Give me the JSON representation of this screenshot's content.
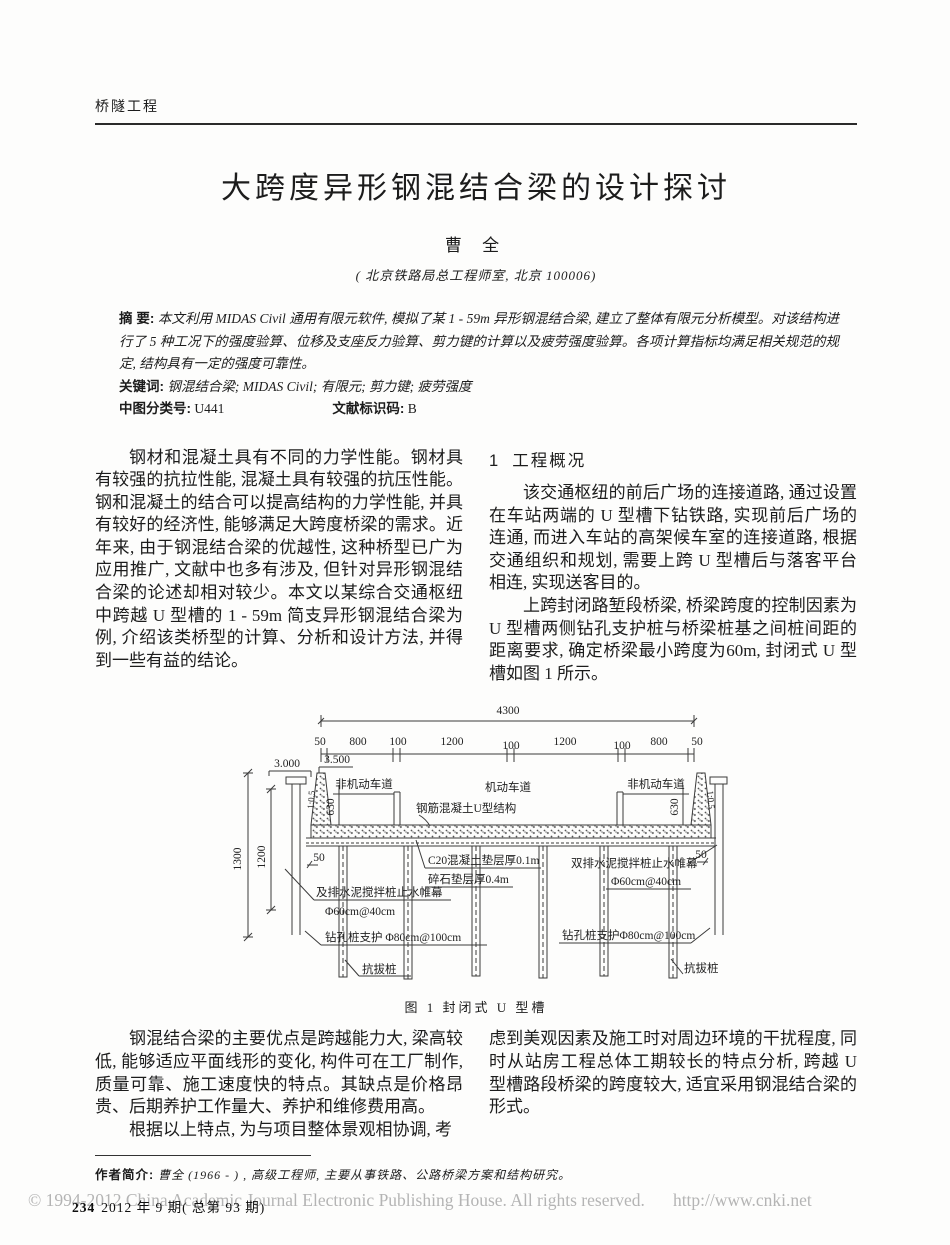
{
  "page": {
    "column_header": "桥隧工程",
    "title": "大跨度异形钢混结合梁的设计探讨",
    "author": "曹  全",
    "affiliation": "( 北京铁路局总工程师室, 北京  100006)"
  },
  "abstract": {
    "label": "摘  要:",
    "text": "本文利用 MIDAS Civil 通用有限元软件, 模拟了某 1 - 59m 异形钢混结合梁, 建立了整体有限元分析模型。对该结构进行了 5 种工况下的强度验算、位移及支座反力验算、剪力键的计算以及疲劳强度验算。各项计算指标均满足相关规范的规定, 结构具有一定的强度可靠性。",
    "keywords_label": "关键词:",
    "keywords": "钢混结合梁;  MIDAS Civil;  有限元;  剪力键;  疲劳强度",
    "clc_label": "中图分类号:",
    "clc_value": "U441",
    "doc_label": "文献标识码:",
    "doc_value": "B"
  },
  "body": {
    "intro": "钢材和混凝土具有不同的力学性能。钢材具有较强的抗拉性能, 混凝土具有较强的抗压性能。钢和混凝土的结合可以提高结构的力学性能, 并具有较好的经济性, 能够满足大跨度桥梁的需求。近年来, 由于钢混结合梁的优越性, 这种桥型已广为应用推广, 文献中也多有涉及, 但针对异形钢混结合梁的论述却相对较少。本文以某综合交通枢纽中跨越 U 型槽的 1 - 59m 简支异形钢混结合梁为例, 介绍该类桥型的计算、分析和设计方法, 并得到一些有益的结论。",
    "section1_num": "1",
    "section1_heading": "工程概况",
    "section1_para1": "该交通枢纽的前后广场的连接道路, 通过设置在车站两端的 U 型槽下钻铁路, 实现前后广场的连通, 而进入车站的高架候车室的连接道路, 根据交通组织和规划, 需要上跨 U 型槽后与落客平台相连, 实现送客目的。",
    "section1_para2": "上跨封闭路堑段桥梁, 桥梁跨度的控制因素为 U 型槽两侧钻孔支护桩与桥梁桩基之间桩间距的距离要求, 确定桥梁最小跨度为60m, 封闭式 U 型槽如图 1 所示。",
    "advantages": "钢混结合梁的主要优点是跨越能力大, 梁高较低, 能够适应平面线形的变化, 构件可在工厂制作, 质量可靠、施工速度快的特点。其缺点是价格昂贵、后期养护工作量大、养护和维修费用高。",
    "continuation_left": "根据以上特点, 为与项目整体景观相协调, 考",
    "continuation_right": "虑到美观因素及施工时对周边环境的干扰程度, 同时从站房工程总体工期较长的特点分析, 跨越 U 型槽路段桥梁的跨度较大, 适宜采用钢混结合梁的形式。"
  },
  "figure": {
    "caption": "图 1   封闭式 U 型槽",
    "dim_total": "4300",
    "dim_segments": [
      "50",
      "800",
      "100",
      "1200",
      "100",
      "1200",
      "100",
      "800",
      "50"
    ],
    "elev_left": "3.000",
    "elev_right": "3.500",
    "dim_1300": "1300",
    "dim_1200": "1200",
    "dim_630_left": "630",
    "dim_630_right": "630",
    "dim_50_left": "50",
    "dim_50_right": "50",
    "slope_left": "1:0.5",
    "slope_right": "1:0.5",
    "label_nonmotor_left": "非机动车道",
    "label_motor": "机动车道",
    "label_nonmotor_right": "非机动车道",
    "label_u_structure": "钢筋混凝土U型结构",
    "label_c20": "C20混凝土垫层厚0.1m",
    "label_gravel": "碎石垫层厚0.4m",
    "label_curtain_right_1": "双排水泥搅拌桩止水帷幕",
    "label_curtain_right_2": "Φ60cm@40cm",
    "label_curtain_left_1": "及排水泥搅拌桩止水帷幕",
    "label_curtain_left_2": "Φ60cm@40cm",
    "label_bored_pile_left": "钻孔桩支护 Φ80cm@100cm",
    "label_bored_pile_right": "钻孔桩支护Φ80cm@100cm",
    "label_uplift_left": "抗拔桩",
    "label_uplift_right": "抗拔桩"
  },
  "footnote": {
    "bio_label": "作者简介:",
    "bio": "曹全 (1966 - ) , 高级工程师, 主要从事铁路、公路桥梁方案和结构研究。"
  },
  "footer": {
    "page_number": "234",
    "issue": "2012 年 9 期( 总第 93 期)",
    "copyright": "© 1994-2012 China Academic Journal Electronic Publishing House. All rights reserved.",
    "url": "http://www.cnki.net"
  }
}
